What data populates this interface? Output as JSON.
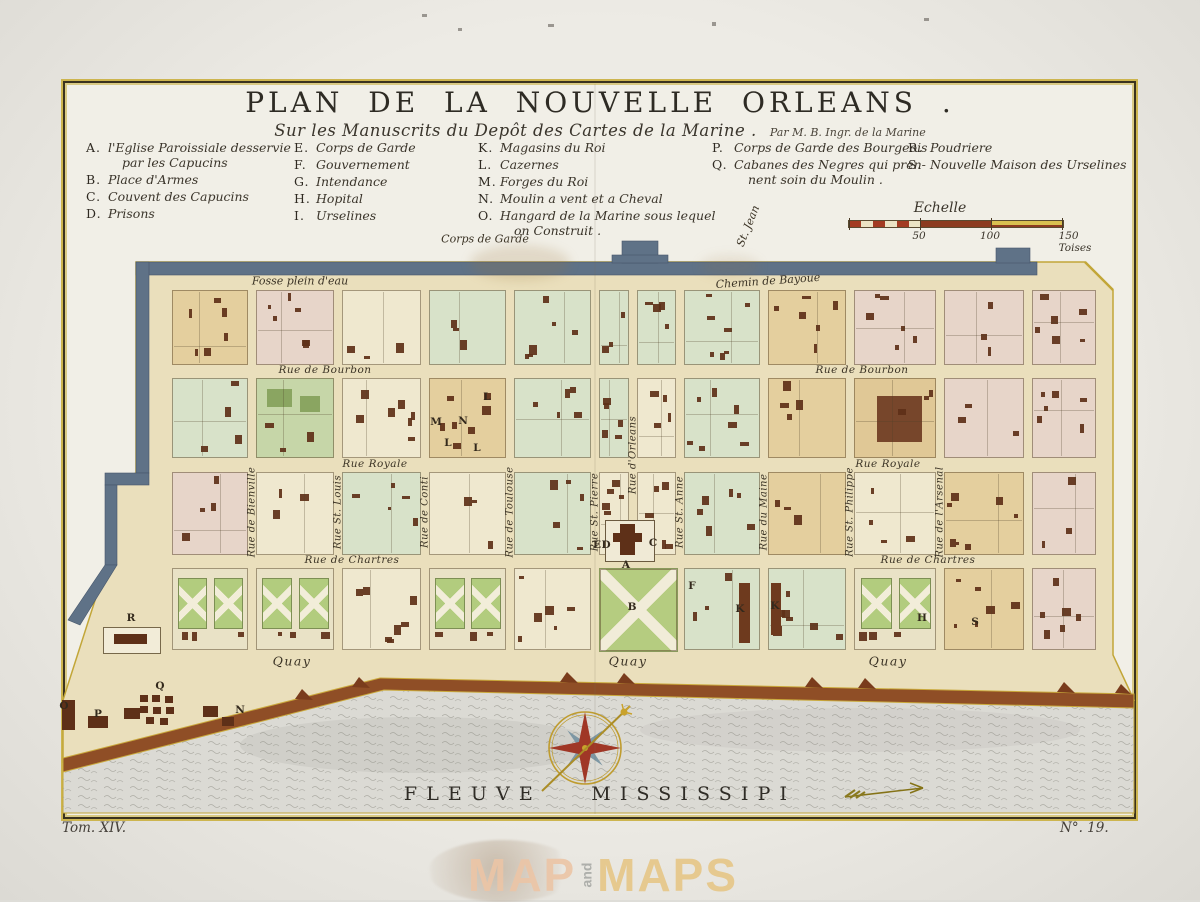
{
  "title": "PLAN DE LA NOUVELLE ORLEANS .",
  "subtitle": "Sur les Manuscrits du Depôt des Cartes de la Marine .",
  "attribution": "Par M. B. Ingr. de la Marine",
  "legend": {
    "columns": [
      {
        "x": 86,
        "items": [
          {
            "key": "A.",
            "lines": [
              "l'Eglise Paroissiale desservie",
              "par les Capucins"
            ]
          },
          {
            "key": "B.",
            "lines": [
              "Place d'Armes"
            ]
          },
          {
            "key": "C.",
            "lines": [
              "Couvent des Capucins"
            ]
          },
          {
            "key": "D.",
            "lines": [
              "Prisons"
            ]
          }
        ]
      },
      {
        "x": 294,
        "items": [
          {
            "key": "E.",
            "lines": [
              "Corps de Garde"
            ]
          },
          {
            "key": "F.",
            "lines": [
              "Gouvernement"
            ]
          },
          {
            "key": "G.",
            "lines": [
              "Intendance"
            ]
          },
          {
            "key": "H.",
            "lines": [
              "Hopital"
            ]
          },
          {
            "key": "I.",
            "lines": [
              "Urselines"
            ]
          }
        ]
      },
      {
        "x": 478,
        "items": [
          {
            "key": "K.",
            "lines": [
              "Magasins du Roi"
            ]
          },
          {
            "key": "L.",
            "lines": [
              "Cazernes"
            ]
          },
          {
            "key": "M.",
            "lines": [
              "Forges du Roi"
            ]
          },
          {
            "key": "N.",
            "lines": [
              "Moulin a vent et a Cheval"
            ]
          },
          {
            "key": "O.",
            "lines": [
              "Hangard de la Marine sous lequel",
              "on Construit ."
            ]
          }
        ]
      },
      {
        "x": 712,
        "items": [
          {
            "key": "P.",
            "lines": [
              "Corps de Garde des Bourgeois"
            ]
          },
          {
            "key": "Q.",
            "lines": [
              "Cabanes des Negres qui pren-",
              "nent soin du Moulin ."
            ]
          }
        ]
      },
      {
        "x": 908,
        "items": [
          {
            "key": "R.",
            "lines": [
              "Poudriere"
            ]
          },
          {
            "key": "S.",
            "lines": [
              "Nouvelle Maison des Urselines"
            ]
          }
        ]
      }
    ]
  },
  "scale": {
    "title": "Echelle",
    "ticks": [
      "50",
      "100",
      "150 Toises"
    ],
    "tick_x": [
      919,
      990,
      1075
    ]
  },
  "map": {
    "top_labels": [
      {
        "text": "Corps de Garde",
        "x": 485,
        "y": 239,
        "rot": 0
      },
      {
        "text": "Fosse plein d'eau",
        "x": 300,
        "y": 281,
        "rot": 0
      },
      {
        "text": "Chemin de Bayoue",
        "x": 768,
        "y": 281,
        "rot": -4
      },
      {
        "text": "St. Jean",
        "x": 748,
        "y": 226,
        "rot": -68
      }
    ],
    "streets_h": [
      {
        "text": "Rue de Bourbon",
        "x": 325,
        "y": 370
      },
      {
        "text": "Rue de Bourbon",
        "x": 862,
        "y": 370
      },
      {
        "text": "Rue Royale",
        "x": 375,
        "y": 464
      },
      {
        "text": "Rue Royale",
        "x": 888,
        "y": 464
      },
      {
        "text": "Rue de Chartres",
        "x": 352,
        "y": 560
      },
      {
        "text": "Rue de Chartres",
        "x": 928,
        "y": 560
      }
    ],
    "streets_v": [
      {
        "text": "Rue de Bienville",
        "x": 252,
        "y": 512
      },
      {
        "text": "Rue St. Louis",
        "x": 338,
        "y": 512
      },
      {
        "text": "Rue de Conti",
        "x": 425,
        "y": 512
      },
      {
        "text": "Rue de Toulouse",
        "x": 510,
        "y": 512
      },
      {
        "text": "Rue St. Pierre",
        "x": 595,
        "y": 512
      },
      {
        "text": "Rue d'Orleans",
        "x": 633,
        "y": 455
      },
      {
        "text": "Rue St. Anne",
        "x": 680,
        "y": 512
      },
      {
        "text": "Rue du Maine",
        "x": 764,
        "y": 512
      },
      {
        "text": "Rue St. Philippe",
        "x": 850,
        "y": 512
      },
      {
        "text": "Rue de l'Arsenal",
        "x": 940,
        "y": 512
      }
    ],
    "quay_labels": [
      {
        "text": "Quay",
        "x": 292,
        "y": 661
      },
      {
        "text": "Quay",
        "x": 628,
        "y": 661
      },
      {
        "text": "Quay",
        "x": 888,
        "y": 661
      }
    ],
    "markers": [
      {
        "t": "R",
        "x": 131,
        "y": 618
      },
      {
        "t": "Q",
        "x": 160,
        "y": 686
      },
      {
        "t": "O",
        "x": 64,
        "y": 706
      },
      {
        "t": "P",
        "x": 98,
        "y": 714
      },
      {
        "t": "N",
        "x": 240,
        "y": 710
      },
      {
        "t": "M",
        "x": 436,
        "y": 422
      },
      {
        "t": "N",
        "x": 463,
        "y": 421
      },
      {
        "t": "L",
        "x": 487,
        "y": 397
      },
      {
        "t": "L",
        "x": 448,
        "y": 443
      },
      {
        "t": "L",
        "x": 477,
        "y": 448
      },
      {
        "t": "E",
        "x": 597,
        "y": 545
      },
      {
        "t": "D",
        "x": 606,
        "y": 545
      },
      {
        "t": "C",
        "x": 653,
        "y": 543
      },
      {
        "t": "A",
        "x": 626,
        "y": 565
      },
      {
        "t": "B",
        "x": 632,
        "y": 607
      },
      {
        "t": "F",
        "x": 692,
        "y": 586
      },
      {
        "t": "K",
        "x": 740,
        "y": 609
      },
      {
        "t": "K",
        "x": 775,
        "y": 606
      },
      {
        "t": "H",
        "x": 922,
        "y": 618
      },
      {
        "t": "S",
        "x": 975,
        "y": 622
      }
    ],
    "river_label": "Fleuve Mississipi",
    "grid": {
      "col_bounds": [
        168,
        252,
        338,
        425,
        510,
        595,
        680,
        764,
        850,
        940,
        1028,
        1100
      ],
      "rows": [
        {
          "y": 290,
          "h": 75
        },
        {
          "y": 378,
          "h": 80
        },
        {
          "y": 472,
          "h": 83
        },
        {
          "y": 568,
          "h": 82
        }
      ],
      "matrix": [
        [
          "t",
          "p",
          "c",
          "g",
          "g",
          "g|g",
          "g",
          "t",
          "p",
          "p",
          "p"
        ],
        [
          "g",
          "d",
          "c",
          "t",
          "g",
          "g|c",
          "g",
          "t",
          "T",
          "p",
          "p"
        ],
        [
          "p",
          "c",
          "g",
          "c",
          "g",
          "c|c",
          "g",
          "t",
          "c",
          "t",
          "p"
        ],
        [
          "G",
          "G",
          "c",
          "G",
          "c",
          "P",
          "g",
          "g",
          "G",
          "t",
          "p"
        ]
      ],
      "split_x": 633
    },
    "palette": {
      "t": "#e4cf9e",
      "p": "#e7d5c9",
      "c": "#efe8cf",
      "g": "#d8e2c9",
      "d": "#c6d6a8",
      "T": "#e0c896",
      "G": "#e9e2c6",
      "P": "#b5cc80",
      "building": "#5e3018",
      "wall": "#5f7287",
      "ground": "#eadfbc",
      "bank": "#8f4e26",
      "gold": "#c2a638",
      "water": "#dbdad4"
    }
  },
  "footer": {
    "tome": "Tom. XIV.",
    "number": "N°. 19."
  },
  "watermark": {
    "word1": "MAP",
    "word2": "and",
    "word3": "MAPS"
  }
}
